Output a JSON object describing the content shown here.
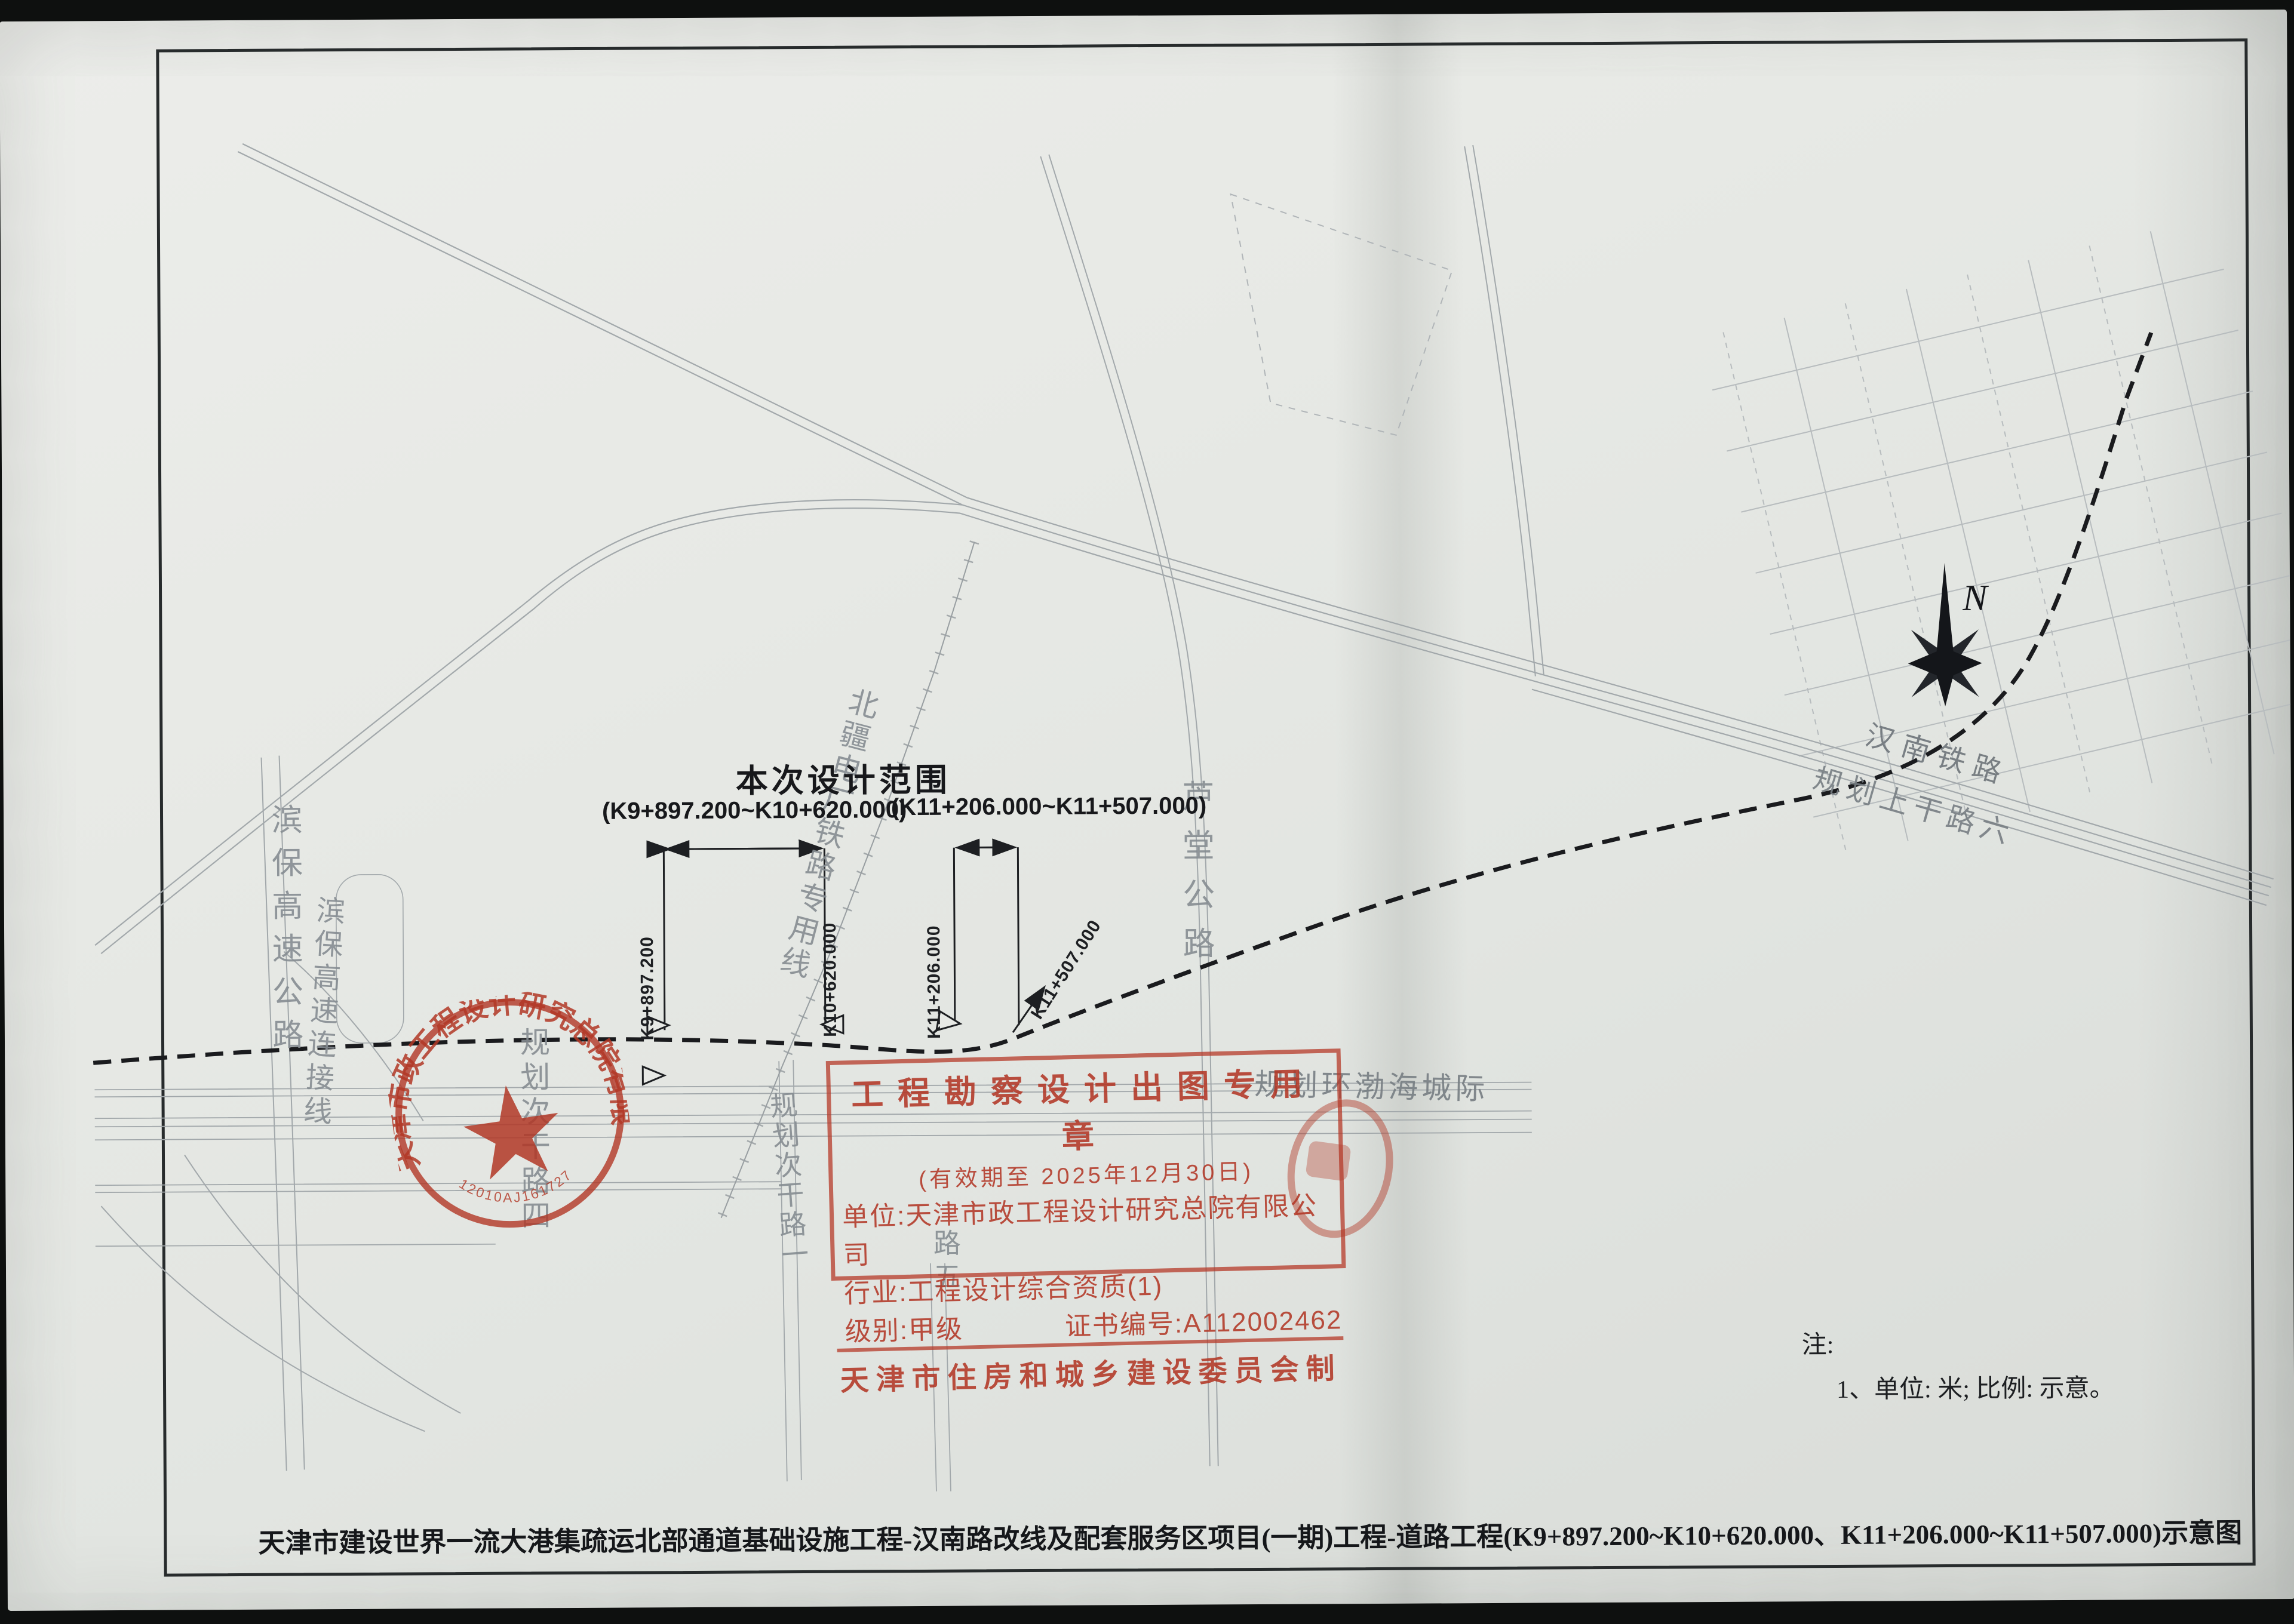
{
  "title": {
    "text": "天津市建设世界一流大港集疏运北部通道基础设施工程-汉南路改线及配套服务区项目(一期)工程-道路工程(K9+897.200~K10+620.000、K11+206.000~K11+507.000)示意图"
  },
  "design_range": {
    "label": "本次设计范围",
    "range1": "(K9+897.200~K10+620.000)",
    "range2": "(K11+206.000~K11+507.000)"
  },
  "stations": {
    "s1": "K9+897.200",
    "s2": "K10+620.000",
    "s3": "K11+206.000",
    "s4": "K11+507.000"
  },
  "labels": {
    "binbao_expressway": "滨保高速公路",
    "binbao_connector": "滨保高速连接线",
    "beijiang_rail_spur": "北疆电厂铁路专用线",
    "lutang_highway": "芦堂公路",
    "hannan_railway": "汉南铁路",
    "planned_shanggan_rd6": "规划上干路六",
    "planned_huanbohai": "规划环渤海城际",
    "planned_cigan_rd1": "规划次干路一",
    "planned_rd4": "规划次干路四",
    "planned_rd5_partial": "路五"
  },
  "north_label": "N",
  "notes": {
    "heading": "注:",
    "item1": "1、单位: 米; 比例: 示意。"
  },
  "stamps": {
    "round": {
      "company": "天津市政工程设计研究总院有限公司",
      "serial": "12010AJ161727"
    },
    "rect": {
      "line1": "工程勘察设计出图专用章",
      "line2": "(有效期至 2025年12月30日)",
      "line3": "单位:天津市政工程设计研究总院有限公司",
      "line4": "行业:工程设计综合资质(1)",
      "line5_left": "级别:甲级",
      "line5_right": "证书编号:A112002462",
      "line6": "天津市住房和城乡建设委员会制"
    }
  },
  "colors": {
    "stamp_red": "#b23726",
    "paper": "#e7e9e5",
    "road_gray": "#a2a8ab",
    "ink": "#1d1f22"
  }
}
